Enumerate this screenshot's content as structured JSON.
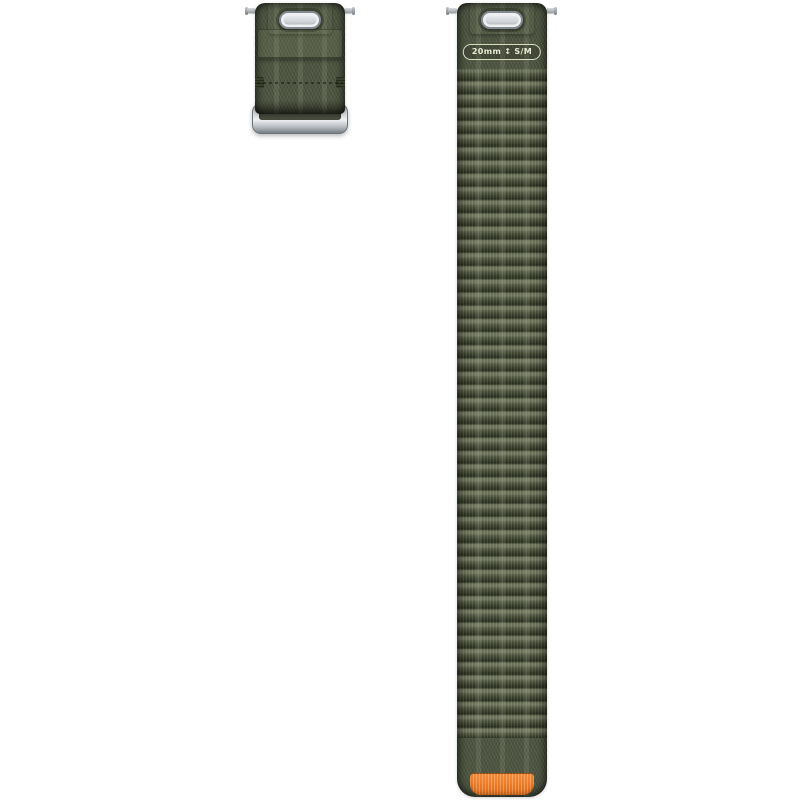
{
  "band": {
    "size_label": {
      "width": "20mm",
      "separator_icon": "↕",
      "size": "S/M"
    },
    "colors": {
      "fabric_green": "#4d5440",
      "fabric_highlight": "#70765e",
      "fabric_shadow": "#2a3020",
      "metal_light": "#eef0f2",
      "metal_mid": "#b9bec3",
      "metal_dark": "#6f757b",
      "accent_orange": "#ee7c28",
      "background": "#ffffff"
    }
  }
}
